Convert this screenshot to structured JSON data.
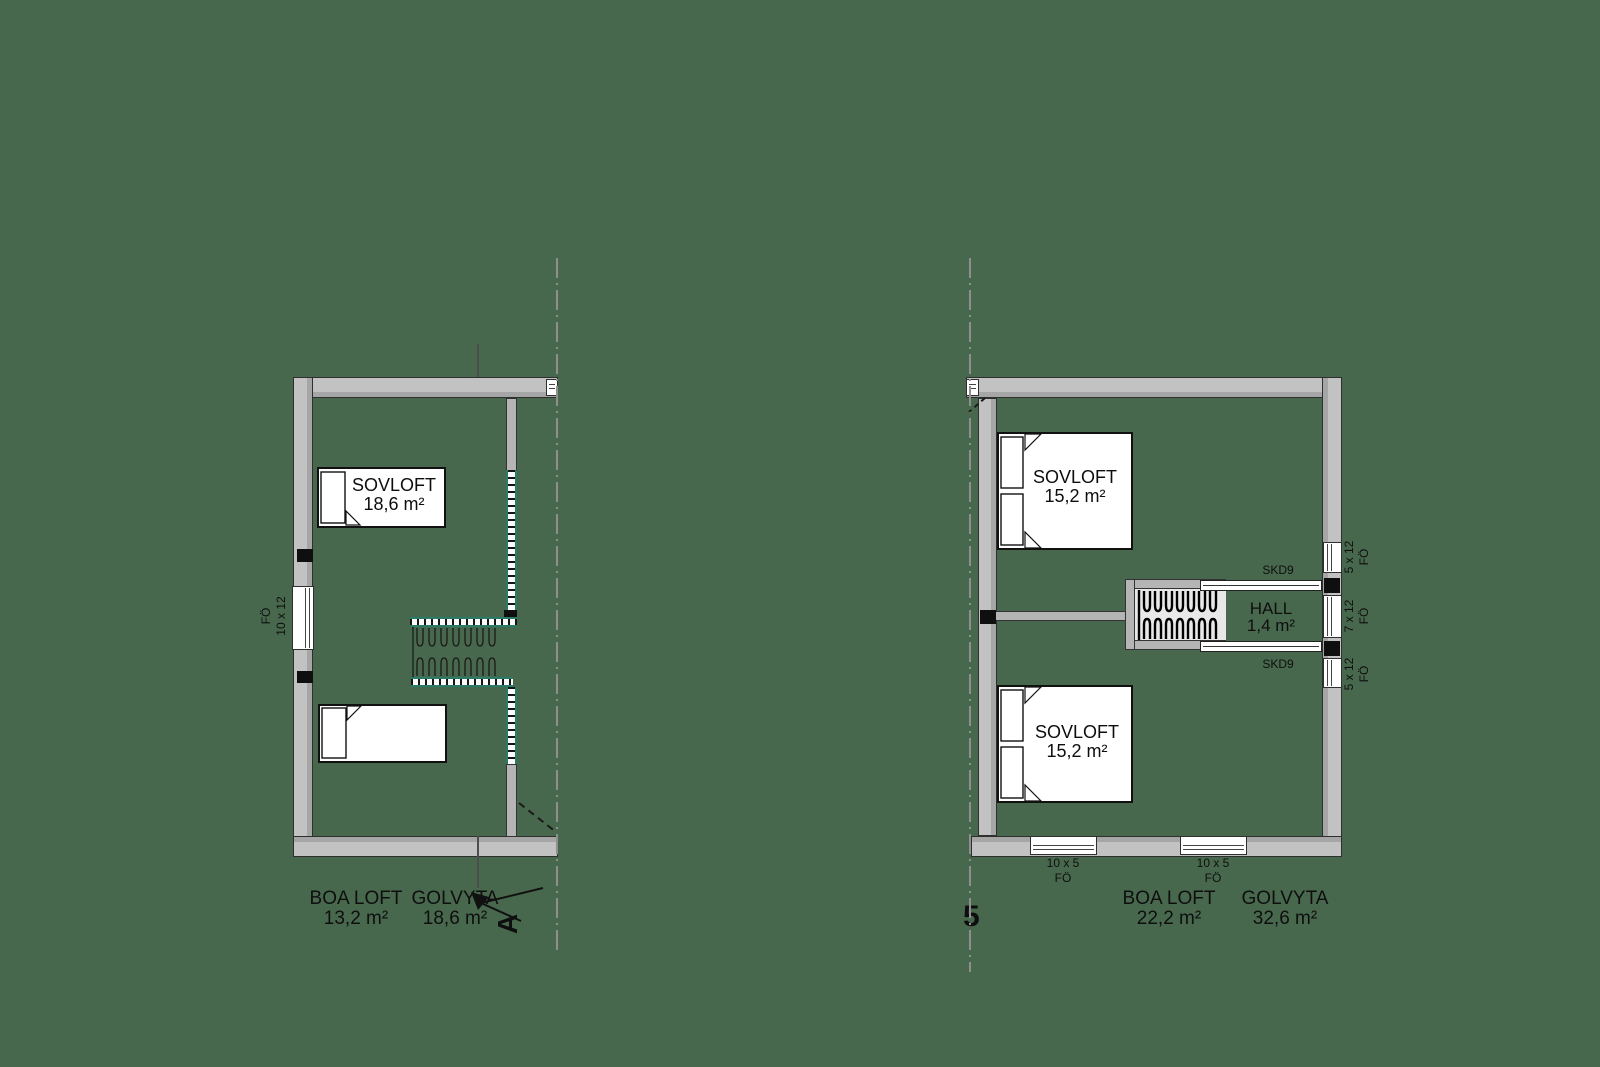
{
  "colors": {
    "background": "#48684e",
    "wall_fill": "#c2c2c2",
    "wall_shade": "#a6a6a6",
    "railing_accent": "#2a7a68",
    "line_dark": "#111111"
  },
  "left_plan": {
    "room": {
      "name": "SOVLOFT",
      "area": "18,6 m²"
    },
    "window_left": {
      "type": "FÖ",
      "size": "10 x 12"
    },
    "summary": {
      "boa_label": "BOA LOFT",
      "boa_area": "13,2 m²",
      "golv_label": "GOLVYTA",
      "golv_area": "18,6 m²"
    },
    "section_letter": "A"
  },
  "right_plan": {
    "room_top": {
      "name": "SOVLOFT",
      "area": "15,2 m²"
    },
    "room_bottom": {
      "name": "SOVLOFT",
      "area": "15,2 m²"
    },
    "hall": {
      "name": "HALL",
      "area": "1,4 m²"
    },
    "door_top": "SKD9",
    "door_bottom": "SKD9",
    "windows_right": [
      {
        "size": "5 x 12",
        "type": "FÖ"
      },
      {
        "size": "7 x 12",
        "type": "FÖ"
      },
      {
        "size": "5 x 12",
        "type": "FÖ"
      }
    ],
    "windows_bottom": [
      {
        "size": "10 x 5",
        "type": "FÖ"
      },
      {
        "size": "10 x 5",
        "type": "FÖ"
      }
    ],
    "summary": {
      "boa_label": "BOA LOFT",
      "boa_area": "22,2 m²",
      "golv_label": "GOLVYTA",
      "golv_area": "32,6 m²"
    },
    "partial_glyph": "5"
  }
}
